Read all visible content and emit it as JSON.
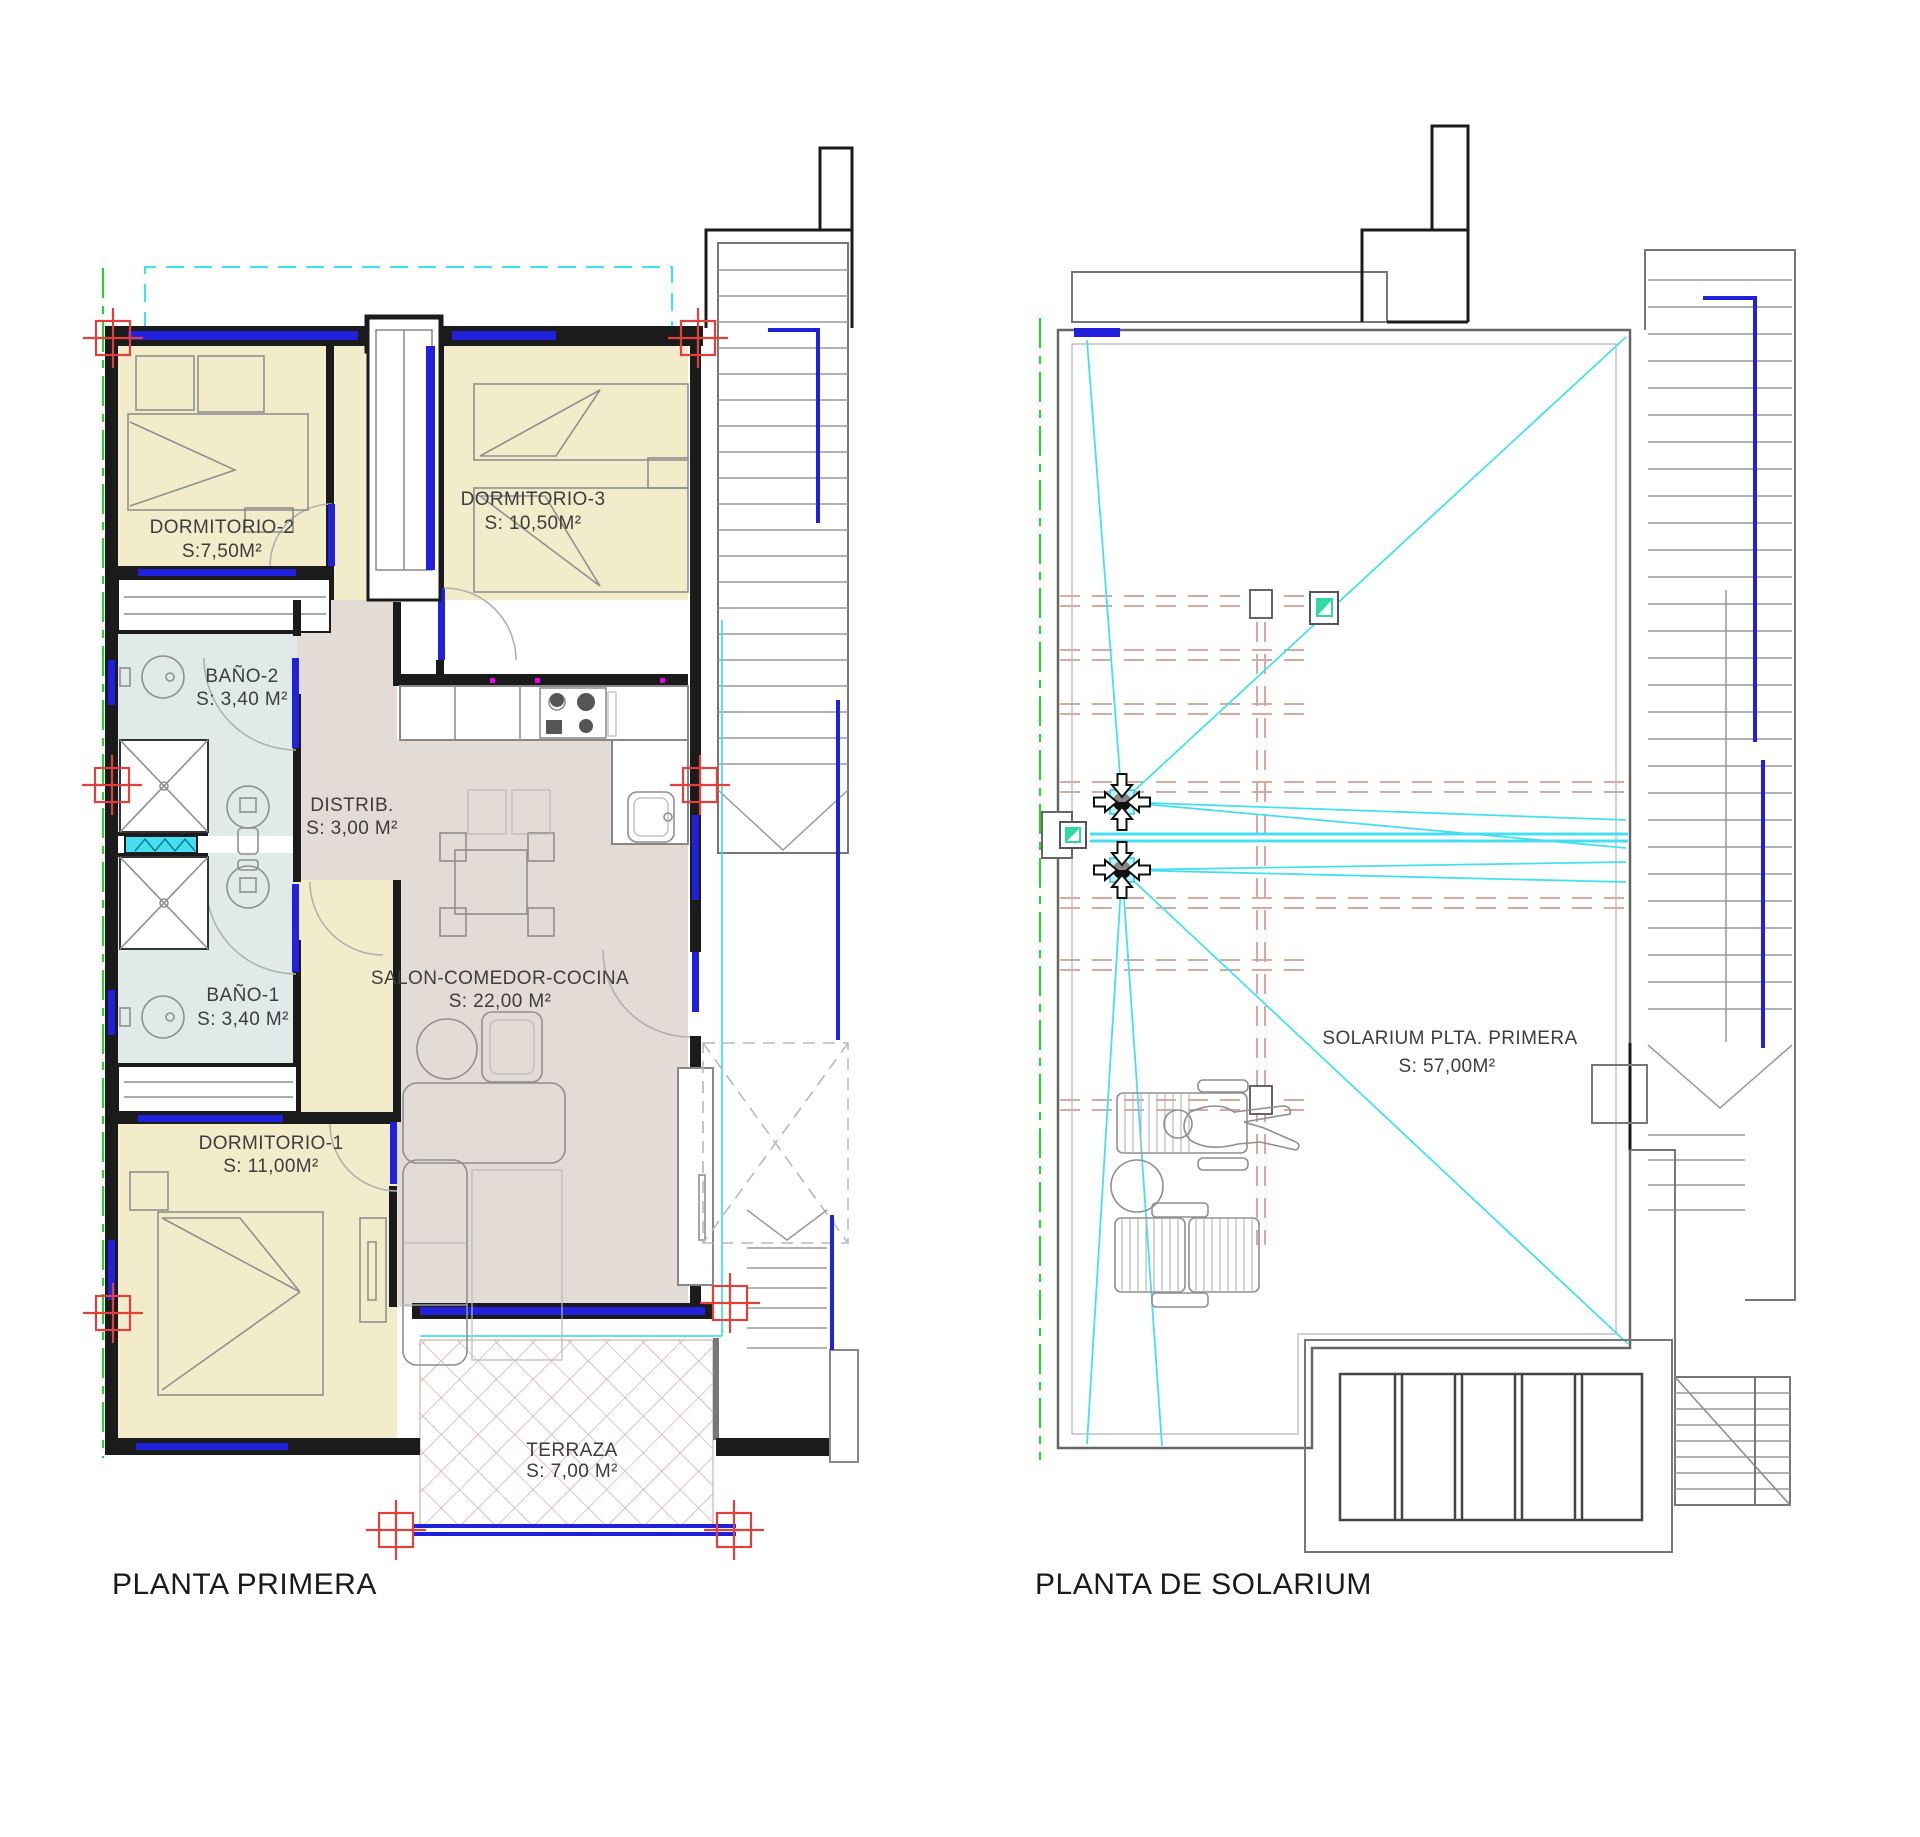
{
  "document": {
    "background": "#ffffff",
    "type": "architectural floor plan drawing"
  },
  "colors": {
    "cream": "#f3ecca",
    "mauve": "#e3dbd5",
    "bath": "#dfeae9",
    "wall": "#1b1b1b",
    "blue": "#2020dd",
    "cyan": "#45e0f0",
    "green": "#2fcc3a",
    "red": "#e0413a",
    "salmon": "#d6aaa0",
    "hatch": "#c9a399",
    "gray": "#8f8f8f",
    "teal": "#2fd9a4",
    "magenta": "#ee00ee",
    "text": "#3d3d3d"
  },
  "plans": {
    "primera": {
      "title": "PLANTA PRIMERA",
      "rooms": {
        "dormitorio2": {
          "name": "DORMITORIO-2",
          "area": "S:7,50M²"
        },
        "dormitorio3": {
          "name": "DORMITORIO-3",
          "area": "S: 10,50M²"
        },
        "bano2": {
          "name": "BAÑO-2",
          "area": "S: 3,40 M²"
        },
        "distribuidor": {
          "name": "DISTRIB.",
          "area": "S: 3,00 M²"
        },
        "bano1": {
          "name": "BAÑO-1",
          "area": "S: 3,40 M²"
        },
        "dormitorio1": {
          "name": "DORMITORIO-1",
          "area": "S: 11,00M²"
        },
        "salon": {
          "name": "SALON-COMEDOR-COCINA",
          "area": "S: 22,00 M²"
        },
        "terraza": {
          "name": "TERRAZA",
          "area": "S: 7,00 M²"
        }
      }
    },
    "solarium": {
      "title": "PLANTA DE SOLARIUM",
      "rooms": {
        "solarium": {
          "name": "SOLARIUM PLTA. PRIMERA",
          "area": "S: 57,00M²"
        }
      }
    }
  }
}
